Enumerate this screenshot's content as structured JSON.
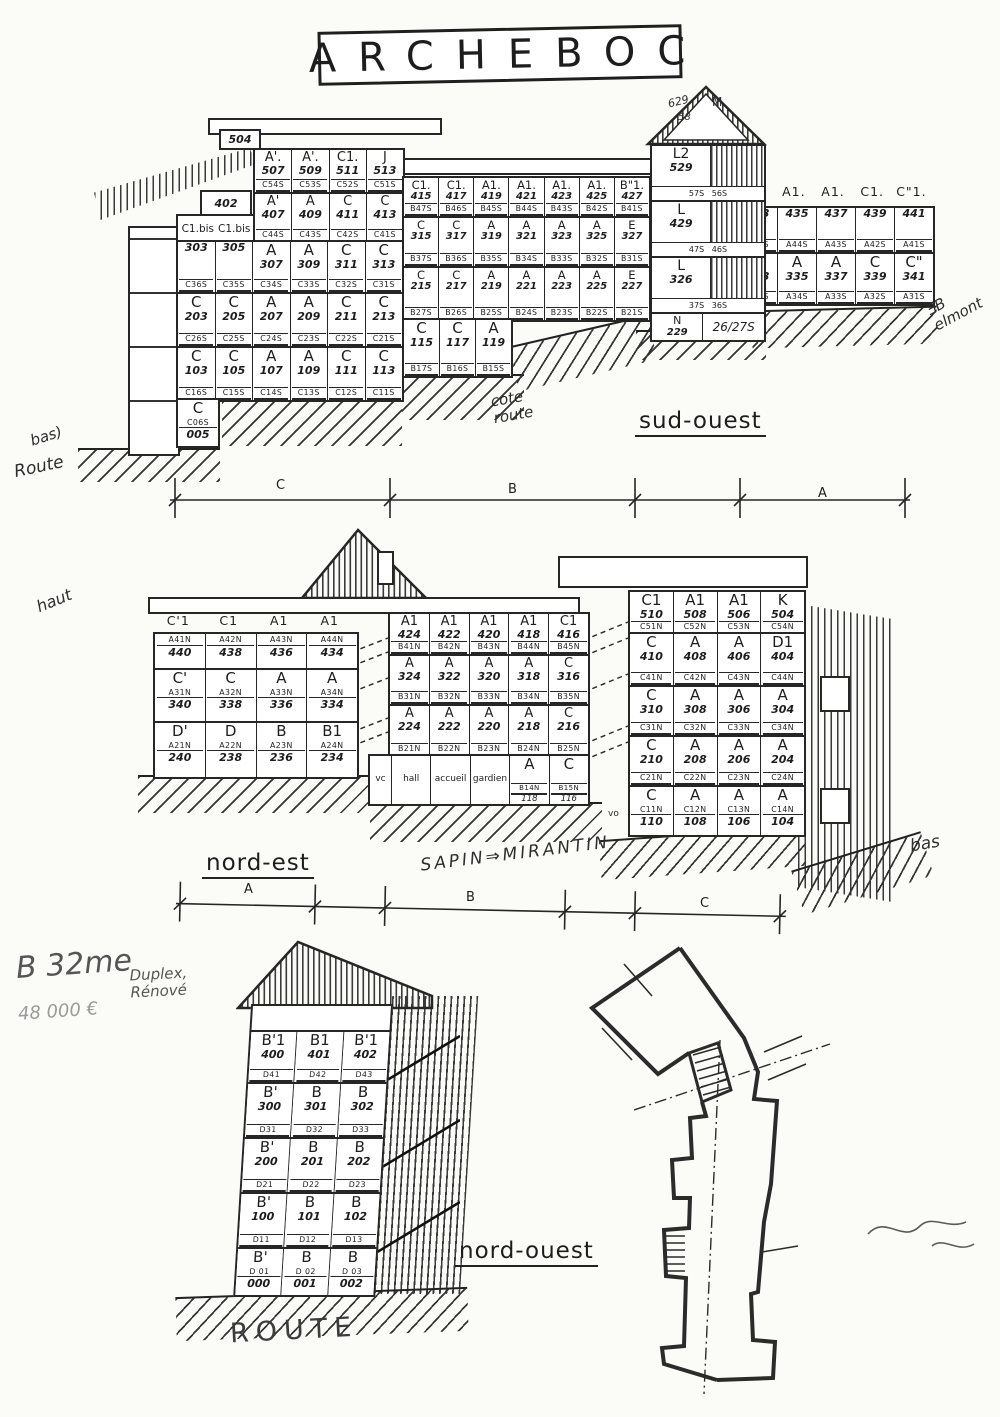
{
  "title": "ARCHEBOC",
  "colors": {
    "ink": "#262626",
    "paper": "#fbfbf8"
  },
  "labels": {
    "sud_ouest": "sud-ouest",
    "nord_est": "nord-est",
    "nord_ouest": "nord-ouest"
  },
  "dims": {
    "e1": [
      "C",
      "B",
      "A"
    ],
    "e2": [
      "A",
      "B",
      "C"
    ]
  },
  "ann": {
    "bas_left": "bas)",
    "route_left": "Route",
    "cote_route": "cote\nroute",
    "elmont": "ƎB\nelmont",
    "haut": "haut",
    "sapin": "SAPIN⇒MIRANTIN",
    "bas_right": "bas",
    "b32": "B 32me",
    "duplex": "Duplex,\nRénové",
    "price": "48 000 €",
    "route": "ROUTE",
    "vo": "vo"
  },
  "sudOuest": {
    "box504": "504",
    "box402": "402",
    "c1bis_a": "C1.bis",
    "c1bis_b": "C1.bis",
    "left_upper": {
      "rows": [
        {
          "h": 44,
          "cells": [
            {
              "t": "A'.",
              "n": "507",
              "c": "C54S"
            },
            {
              "t": "A'.",
              "n": "509",
              "c": "C53S"
            },
            {
              "t": "C1.",
              "n": "511",
              "c": "C52S"
            },
            {
              "t": "J",
              "n": "513",
              "c": "C51S"
            }
          ]
        },
        {
          "h": 48,
          "cells": [
            {
              "t": "A'",
              "n": "407",
              "c": "C44S"
            },
            {
              "t": "A",
              "n": "409",
              "c": "C43S"
            },
            {
              "t": "C",
              "n": "411",
              "c": "C42S"
            },
            {
              "t": "C",
              "n": "413",
              "c": "C41S"
            }
          ]
        }
      ]
    },
    "left_main": {
      "rows": [
        {
          "h": 52,
          "cells": [
            {
              "n": "303",
              "c": "C36S"
            },
            {
              "n": "305",
              "c": "C35S"
            },
            {
              "t": "A",
              "n": "307",
              "c": "C34S"
            },
            {
              "t": "A",
              "n": "309",
              "c": "C33S"
            },
            {
              "t": "C",
              "n": "311",
              "c": "C32S"
            },
            {
              "t": "C",
              "n": "313",
              "c": "C31S"
            }
          ]
        },
        {
          "h": 54,
          "cells": [
            {
              "t": "C",
              "n": "203",
              "c": "C26S"
            },
            {
              "t": "C",
              "n": "205",
              "c": "C25S"
            },
            {
              "t": "A",
              "n": "207",
              "c": "C24S"
            },
            {
              "t": "A",
              "n": "209",
              "c": "C23S"
            },
            {
              "t": "C",
              "n": "211",
              "c": "C22S"
            },
            {
              "t": "C",
              "n": "213",
              "c": "C21S"
            }
          ]
        },
        {
          "h": 52,
          "cells": [
            {
              "t": "C",
              "n": "103",
              "c": "C16S"
            },
            {
              "t": "C",
              "n": "105",
              "c": "C15S"
            },
            {
              "t": "A",
              "n": "107",
              "c": "C14S"
            },
            {
              "t": "A",
              "n": "109",
              "c": "C13S"
            },
            {
              "t": "C",
              "n": "111",
              "c": "C12S"
            },
            {
              "t": "C",
              "n": "113",
              "c": "C11S"
            }
          ]
        }
      ]
    },
    "left_base": {
      "rows": [
        {
          "h": 46,
          "cf": true,
          "cells": [
            {
              "t": "C",
              "c": "C06S",
              "n": "005"
            }
          ]
        }
      ]
    },
    "mid": {
      "rows": [
        {
          "h": 40,
          "cells": [
            {
              "t": "C1.",
              "n": "415",
              "c": "B47S"
            },
            {
              "t": "C1.",
              "n": "417",
              "c": "B46S"
            },
            {
              "t": "A1.",
              "n": "419",
              "c": "B45S"
            },
            {
              "t": "A1.",
              "n": "421",
              "c": "B44S"
            },
            {
              "t": "A1.",
              "n": "423",
              "c": "B43S"
            },
            {
              "t": "A1.",
              "n": "425",
              "c": "B42S"
            },
            {
              "t": "B\"1.",
              "n": "427",
              "c": "B41S"
            }
          ]
        },
        {
          "h": 50,
          "cells": [
            {
              "t": "C",
              "n": "315",
              "c": "B37S"
            },
            {
              "t": "C",
              "n": "317",
              "c": "B36S"
            },
            {
              "t": "A",
              "n": "319",
              "c": "B35S"
            },
            {
              "t": "A",
              "n": "321",
              "c": "B34S"
            },
            {
              "t": "A",
              "n": "323",
              "c": "B33S"
            },
            {
              "t": "A",
              "n": "325",
              "c": "B32S"
            },
            {
              "t": "E",
              "n": "327",
              "c": "B31S"
            }
          ]
        },
        {
          "h": 52,
          "cells": [
            {
              "t": "C",
              "n": "215",
              "c": "B27S"
            },
            {
              "t": "C",
              "n": "217",
              "c": "B26S"
            },
            {
              "t": "A",
              "n": "219",
              "c": "B25S"
            },
            {
              "t": "A",
              "n": "221",
              "c": "B24S"
            },
            {
              "t": "A",
              "n": "223",
              "c": "B23S"
            },
            {
              "t": "A",
              "n": "225",
              "c": "B22S"
            },
            {
              "t": "E",
              "n": "227",
              "c": "B21S"
            }
          ]
        }
      ]
    },
    "mid_r1": {
      "rows": [
        {
          "h": 56,
          "cells": [
            {
              "t": "C",
              "n": "115",
              "c": "B17S"
            },
            {
              "t": "C",
              "n": "117",
              "c": "B16S"
            },
            {
              "t": "A",
              "n": "119",
              "c": "B15S"
            }
          ]
        }
      ]
    },
    "tower": {
      "hand_top": "629",
      "hand_mid": "58",
      "hand_m": "M",
      "floors": [
        {
          "t": "L2",
          "n": "529",
          "c": "57S   56S"
        },
        {
          "t": "L",
          "n": "429",
          "c": "47S   46S"
        },
        {
          "t": "L",
          "n": "326",
          "c": "37S   36S"
        }
      ],
      "base_t": "N",
      "base_n": "229",
      "base_c": "26/27S"
    },
    "right_header": {
      "rows": [
        {
          "h": 20,
          "hdr": true,
          "cells": [
            {
              "t": "B1."
            },
            {
              "t": "A1."
            },
            {
              "t": "A1."
            },
            {
              "t": "C1."
            },
            {
              "t": "C\"1."
            }
          ]
        }
      ]
    },
    "right": {
      "rows": [
        {
          "h": 46,
          "cells": [
            {
              "n": "433",
              "c": "A45S"
            },
            {
              "n": "435",
              "c": "A44S"
            },
            {
              "n": "437",
              "c": "A43S"
            },
            {
              "n": "439",
              "c": "A42S"
            },
            {
              "n": "441",
              "c": "A41S"
            }
          ]
        },
        {
          "h": 50,
          "cells": [
            {
              "t": "B",
              "n": "333",
              "c": "A35S"
            },
            {
              "t": "A",
              "n": "335",
              "c": "A34S"
            },
            {
              "t": "A",
              "n": "337",
              "c": "A33S"
            },
            {
              "t": "C",
              "n": "339",
              "c": "A32S"
            },
            {
              "t": "C\"",
              "n": "341",
              "c": "A31S"
            }
          ]
        }
      ]
    }
  },
  "nordEst": {
    "left_header": {
      "rows": [
        {
          "h": 18,
          "hdr": true,
          "cells": [
            {
              "t": "C'1"
            },
            {
              "t": "C1"
            },
            {
              "t": "A1"
            },
            {
              "t": "A1"
            }
          ]
        }
      ]
    },
    "left": {
      "rows": [
        {
          "h": 36,
          "cf": true,
          "cells": [
            {
              "c": "A41N",
              "n": "440"
            },
            {
              "c": "A42N",
              "n": "438"
            },
            {
              "c": "A43N",
              "n": "436"
            },
            {
              "c": "A44N",
              "n": "434"
            }
          ]
        },
        {
          "h": 53,
          "cf": true,
          "cells": [
            {
              "t": "C'",
              "c": "A31N",
              "n": "340"
            },
            {
              "t": "C",
              "c": "A32N",
              "n": "338"
            },
            {
              "t": "A",
              "c": "A33N",
              "n": "336"
            },
            {
              "t": "A",
              "c": "A34N",
              "n": "334"
            }
          ]
        },
        {
          "h": 54,
          "cf": true,
          "cells": [
            {
              "t": "D'",
              "c": "A21N",
              "n": "240"
            },
            {
              "t": "D",
              "c": "A22N",
              "n": "238"
            },
            {
              "t": "B",
              "c": "A23N",
              "n": "236"
            },
            {
              "t": "B1",
              "c": "A24N",
              "n": "234"
            }
          ]
        }
      ]
    },
    "mid": {
      "rows": [
        {
          "h": 42,
          "cells": [
            {
              "t": "A1",
              "n": "424",
              "c": "B41N"
            },
            {
              "t": "A1",
              "n": "422",
              "c": "B42N"
            },
            {
              "t": "A1",
              "n": "420",
              "c": "B43N"
            },
            {
              "t": "A1",
              "n": "418",
              "c": "B44N"
            },
            {
              "t": "C1",
              "n": "416",
              "c": "B45N"
            }
          ]
        },
        {
          "h": 50,
          "cells": [
            {
              "t": "A",
              "n": "324",
              "c": "B31N"
            },
            {
              "t": "A",
              "n": "322",
              "c": "B32N"
            },
            {
              "t": "A",
              "n": "320",
              "c": "B33N"
            },
            {
              "t": "A",
              "n": "318",
              "c": "B34N"
            },
            {
              "t": "C",
              "n": "316",
              "c": "B35N"
            }
          ]
        },
        {
          "h": 50,
          "cells": [
            {
              "t": "A",
              "n": "224",
              "c": "B21N"
            },
            {
              "t": "A",
              "n": "222",
              "c": "B22N"
            },
            {
              "t": "A",
              "n": "220",
              "c": "B23N"
            },
            {
              "t": "A",
              "n": "218",
              "c": "B24N"
            },
            {
              "t": "C",
              "n": "216",
              "c": "B25N"
            }
          ]
        }
      ]
    },
    "mid_r1": {
      "rows": [
        {
          "h": 48,
          "cells": [
            {
              "t": "vc",
              "w": 22
            },
            {
              "t": "hall"
            },
            {
              "t": "accueil"
            },
            {
              "t": "gardien"
            },
            {
              "t": "A",
              "c": "B14N",
              "s": "118"
            },
            {
              "t": "C",
              "c": "B15N",
              "s": "116"
            }
          ]
        }
      ]
    },
    "right": {
      "rows": [
        {
          "h": 42,
          "cells": [
            {
              "t": "C1",
              "n": "510",
              "c": "C51N"
            },
            {
              "t": "A1",
              "n": "508",
              "c": "C52N"
            },
            {
              "t": "A1",
              "n": "506",
              "c": "C53N"
            },
            {
              "t": "K",
              "n": "504",
              "c": "C54N"
            }
          ]
        },
        {
          "h": 53,
          "cells": [
            {
              "t": "C",
              "n": "410",
              "c": "C41N"
            },
            {
              "t": "A",
              "n": "408",
              "c": "C42N"
            },
            {
              "t": "A",
              "n": "406",
              "c": "C43N"
            },
            {
              "t": "D1",
              "n": "404",
              "c": "C44N"
            }
          ]
        },
        {
          "h": 50,
          "cells": [
            {
              "t": "C",
              "n": "310",
              "c": "C31N"
            },
            {
              "t": "A",
              "n": "308",
              "c": "C32N"
            },
            {
              "t": "A",
              "n": "306",
              "c": "C33N"
            },
            {
              "t": "A",
              "n": "304",
              "c": "C34N"
            }
          ]
        },
        {
          "h": 50,
          "cells": [
            {
              "t": "C",
              "n": "210",
              "c": "C21N"
            },
            {
              "t": "A",
              "n": "208",
              "c": "C22N"
            },
            {
              "t": "A",
              "n": "206",
              "c": "C23N"
            },
            {
              "t": "A",
              "n": "204",
              "c": "C24N"
            }
          ]
        },
        {
          "h": 48,
          "cf": true,
          "cells": [
            {
              "t": "C",
              "c": "C11N",
              "n": "110"
            },
            {
              "t": "A",
              "c": "C12N",
              "n": "108"
            },
            {
              "t": "A",
              "c": "C13N",
              "n": "106"
            },
            {
              "t": "A",
              "c": "C14N",
              "n": "104"
            }
          ]
        }
      ]
    }
  },
  "nordOuest": {
    "grid": {
      "rows": [
        {
          "h": 52,
          "cells": [
            {
              "t": "B'1",
              "n": "400",
              "c": "D41"
            },
            {
              "t": "B1",
              "n": "401",
              "c": "D42"
            },
            {
              "t": "B'1",
              "n": "402",
              "c": "D43"
            }
          ]
        },
        {
          "h": 55,
          "cells": [
            {
              "t": "B'",
              "n": "300",
              "c": "D31"
            },
            {
              "t": "B",
              "n": "301",
              "c": "D32"
            },
            {
              "t": "B",
              "n": "302",
              "c": "D33"
            }
          ]
        },
        {
          "h": 55,
          "cells": [
            {
              "t": "B'",
              "n": "200",
              "c": "D21"
            },
            {
              "t": "B",
              "n": "201",
              "c": "D22"
            },
            {
              "t": "B",
              "n": "202",
              "c": "D23"
            }
          ]
        },
        {
          "h": 55,
          "cells": [
            {
              "t": "B'",
              "n": "100",
              "c": "D11"
            },
            {
              "t": "B",
              "n": "101",
              "c": "D12"
            },
            {
              "t": "B",
              "n": "102",
              "c": "D13"
            }
          ]
        },
        {
          "h": 46,
          "cf": true,
          "cells": [
            {
              "t": "B'",
              "c": "D 01",
              "n": "000"
            },
            {
              "t": "B",
              "c": "D 02",
              "n": "001"
            },
            {
              "t": "B",
              "c": "D 03",
              "n": "002"
            }
          ]
        }
      ]
    }
  }
}
